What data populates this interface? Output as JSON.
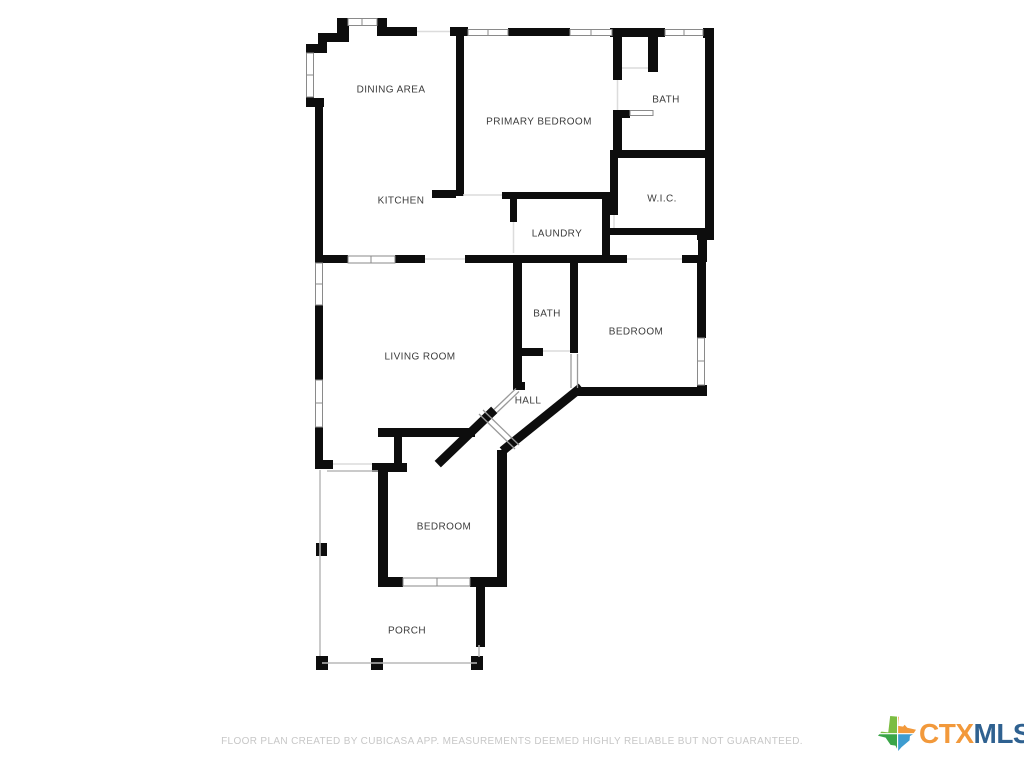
{
  "floor_plan": {
    "wall_color": "#0d0d0d",
    "label_color": "#3c3c3c",
    "rooms": [
      {
        "id": "dining-area",
        "name": "DINING AREA"
      },
      {
        "id": "primary-bedroom",
        "name": "PRIMARY BEDROOM"
      },
      {
        "id": "bath-top",
        "name": "BATH"
      },
      {
        "id": "kitchen",
        "name": "KITCHEN"
      },
      {
        "id": "laundry",
        "name": "LAUNDRY"
      },
      {
        "id": "wic",
        "name": "W.I.C."
      },
      {
        "id": "bath-middle",
        "name": "BATH"
      },
      {
        "id": "bedroom-right",
        "name": "BEDROOM"
      },
      {
        "id": "living-room",
        "name": "LIVING ROOM"
      },
      {
        "id": "hall",
        "name": "HALL"
      },
      {
        "id": "bedroom-bottom",
        "name": "BEDROOM"
      },
      {
        "id": "porch",
        "name": "PORCH"
      }
    ]
  },
  "footer": {
    "disclaimer": "FLOOR PLAN CREATED BY CUBICASA APP. MEASUREMENTS DEEMED HIGHLY RELIABLE BUT NOT GUARANTEED.",
    "color": "#c7c7c7"
  },
  "logo": {
    "text_primary": "CTX",
    "text_secondary": "MLS",
    "primary_color": "#F2993B",
    "secondary_color": "#2F6190",
    "icon": "texas-icon",
    "icon_colors": {
      "top_left": "#7CBD42",
      "top_right": "#F2993B",
      "bottom_left": "#3AA548",
      "bottom_right": "#3E9CD0"
    }
  }
}
